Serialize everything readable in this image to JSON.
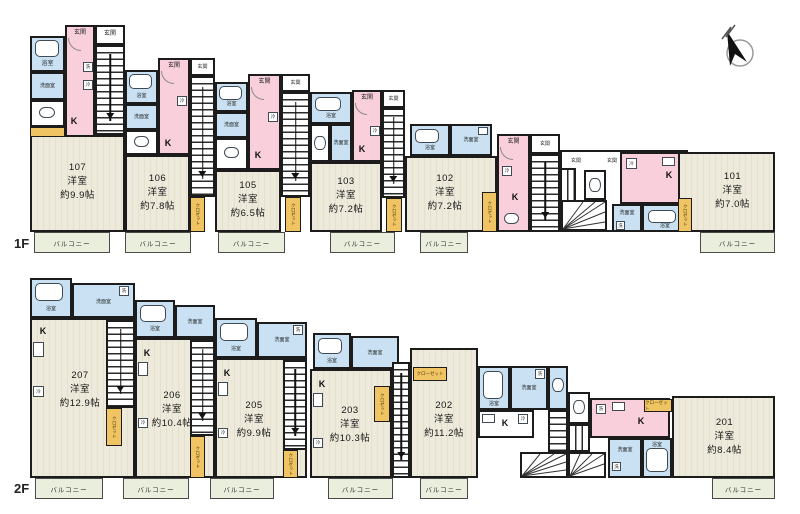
{
  "labels": {
    "floor1": "1F",
    "floor2": "2F",
    "bath": "浴室",
    "washroom": "洗面室",
    "entrance": "玄関",
    "kitchen": "K",
    "fridge": "冷",
    "washer": "洗",
    "closet": "クロゼット",
    "closet_long": "クローゼット",
    "balcony": "バルコニー"
  },
  "units": {
    "u107": {
      "number": "107",
      "type": "洋室",
      "size": "約9.9帖"
    },
    "u106": {
      "number": "106",
      "type": "洋室",
      "size": "約7.8帖"
    },
    "u105": {
      "number": "105",
      "type": "洋室",
      "size": "約6.5帖"
    },
    "u103": {
      "number": "103",
      "type": "洋室",
      "size": "約7.2帖"
    },
    "u102": {
      "number": "102",
      "type": "洋室",
      "size": "約7.2帖"
    },
    "u101": {
      "number": "101",
      "type": "洋室",
      "size": "約7.0帖"
    },
    "u207": {
      "number": "207",
      "type": "洋室",
      "size": "約12.9帖"
    },
    "u206": {
      "number": "206",
      "type": "洋室",
      "size": "約10.4帖"
    },
    "u205": {
      "number": "205",
      "type": "洋室",
      "size": "約9.9帖"
    },
    "u203": {
      "number": "203",
      "type": "洋室",
      "size": "約10.3帖"
    },
    "u202": {
      "number": "202",
      "type": "洋室",
      "size": "約11.2帖"
    },
    "u201": {
      "number": "201",
      "type": "洋室",
      "size": "約8.4帖"
    }
  },
  "icons": {
    "compass": "north-arrow",
    "tub": "bathtub",
    "toilet": "toilet",
    "sink": "sink",
    "stairs": "staircase",
    "winder": "winder-stairs"
  },
  "colors": {
    "wall": "#1c1c1c",
    "room": "#edeadc",
    "wet": "#c9e1f2",
    "hall": "#f8cfdb",
    "closet": "#f1c463",
    "balcony": "#e9efdc"
  }
}
